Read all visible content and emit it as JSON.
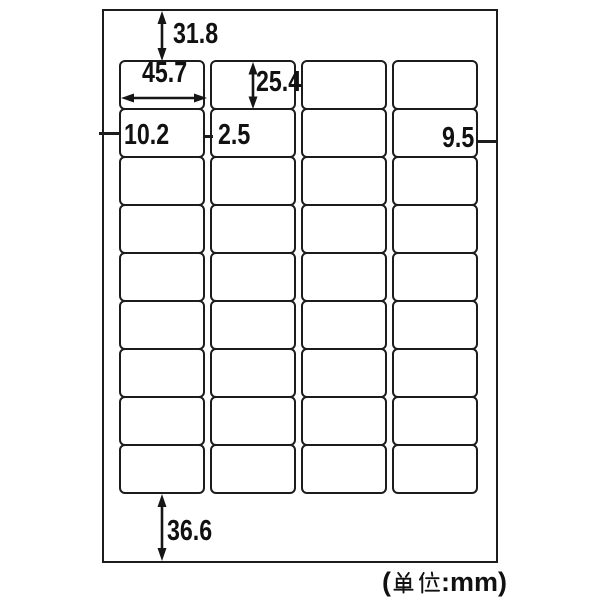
{
  "sheet": {
    "columns": 4,
    "rows": 9
  },
  "dimensions_mm": {
    "top_margin": "31.8",
    "label_width": "45.7",
    "label_height": "25.4",
    "left_margin": "10.2",
    "column_gap": "2.5",
    "right_margin": "9.5",
    "bottom_margin": "36.6"
  },
  "footer": {
    "unit_note": "(単位:mm)",
    "unit_prefix": "(",
    "unit_kanji": "単位",
    "unit_suffix": ":mm)"
  }
}
